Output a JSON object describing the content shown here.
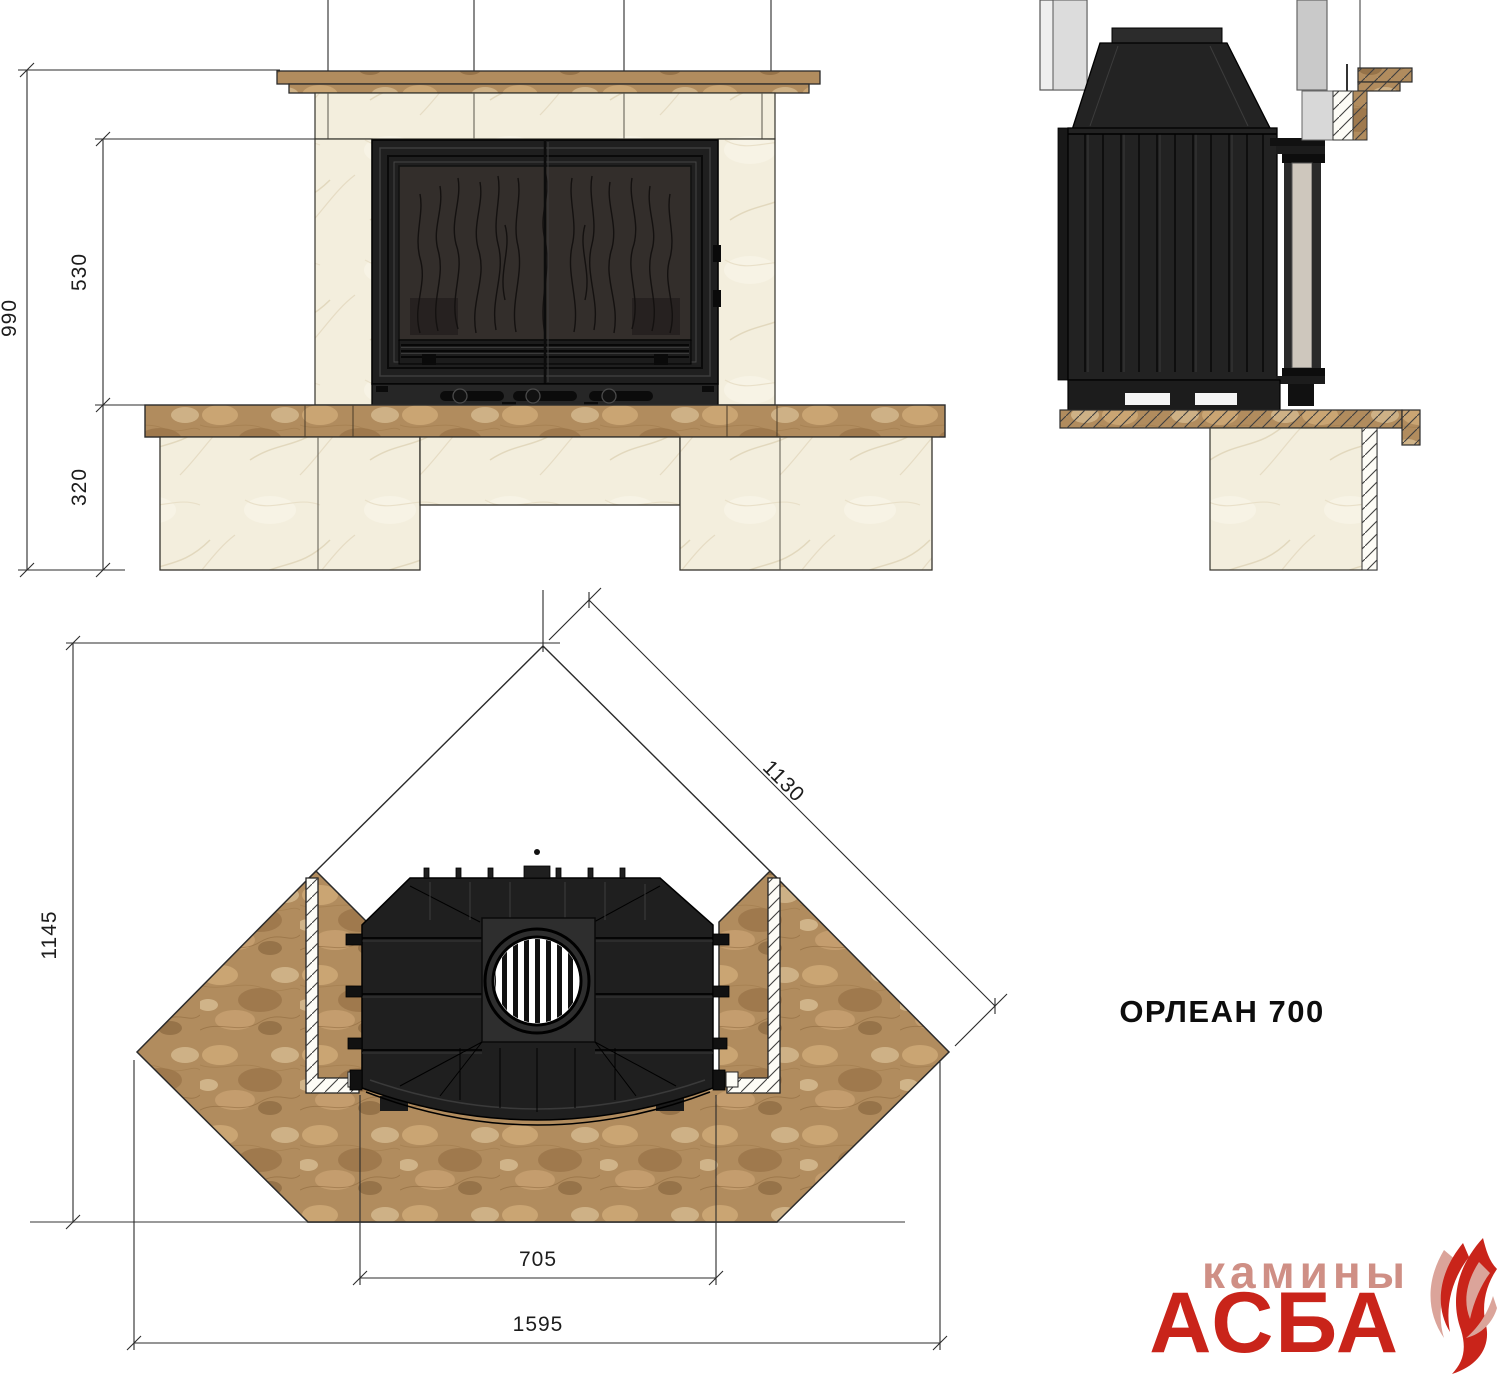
{
  "title": "ОРЛЕАН 700",
  "logo": {
    "tagline": "камины",
    "brand": "АСБА"
  },
  "views": {
    "front": {
      "dims": {
        "total_height": "990",
        "opening_height": "530",
        "hearth_height": "320"
      }
    },
    "plan": {
      "dims": {
        "depth": "1145",
        "wall_length": "1130",
        "inner_width": "705",
        "overall_width": "1595"
      }
    }
  },
  "colors": {
    "logo_red": "#c9241a",
    "logo_pink": "#cf8f85",
    "marble_brown": "#b18c5e",
    "stone_cream": "#f3eedd",
    "cast_iron": "#1f1f1f",
    "dimension_line": "#2b2b2b"
  }
}
